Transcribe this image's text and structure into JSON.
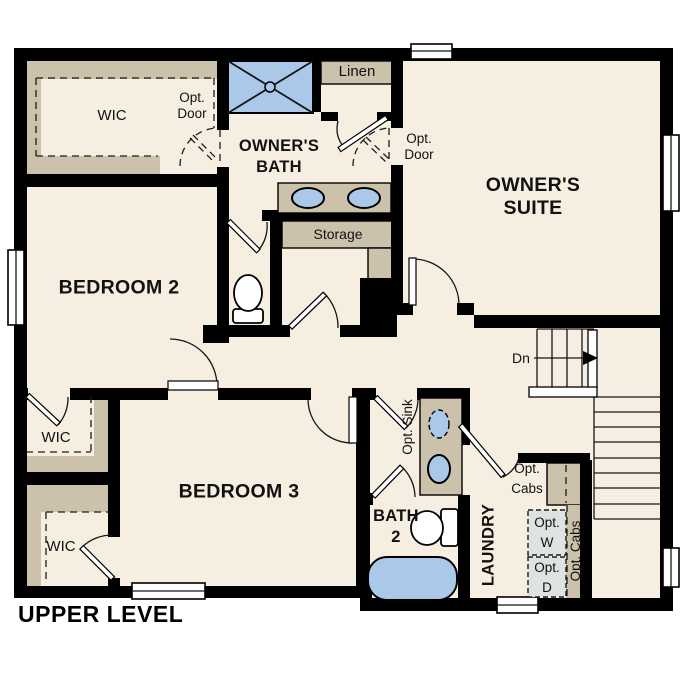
{
  "colors": {
    "wall": "#000000",
    "floor": "#f6eee1",
    "cabinetry_tan": "#ccc2ab",
    "fixture_blue": "#aac9e9",
    "appliance_gray": "#dee2e0",
    "background": "#ffffff"
  },
  "labels": {
    "title": "UPPER LEVEL",
    "owners_wic": "WIC",
    "opt_door1_line1": "Opt.",
    "opt_door1_line2": "Door",
    "owners_bath_line1": "OWNER'S",
    "owners_bath_line2": "BATH",
    "linen": "Linen",
    "opt_door2_line1": "Opt.",
    "opt_door2_line2": "Door",
    "owners_suite_line1": "OWNER'S",
    "owners_suite_line2": "SUITE",
    "storage": "Storage",
    "bedroom2": "BEDROOM 2",
    "bedroom2_wic": "WIC",
    "bedroom3": "BEDROOM 3",
    "bedroom3_wic": "WIC",
    "bath2_line1": "BATH",
    "bath2_line2": "2",
    "opt_sink": "Opt. Sink",
    "laundry": "LAUNDRY",
    "opt_cabs_line1": "Opt.",
    "opt_cabs_line2": "Cabs",
    "opt_washer_line1": "Opt.",
    "opt_washer_line2": "W",
    "opt_dryer_line1": "Opt.",
    "opt_dryer_line2": "D",
    "opt_cabs_vertical": "Opt. Cabs",
    "down": "Dn"
  }
}
